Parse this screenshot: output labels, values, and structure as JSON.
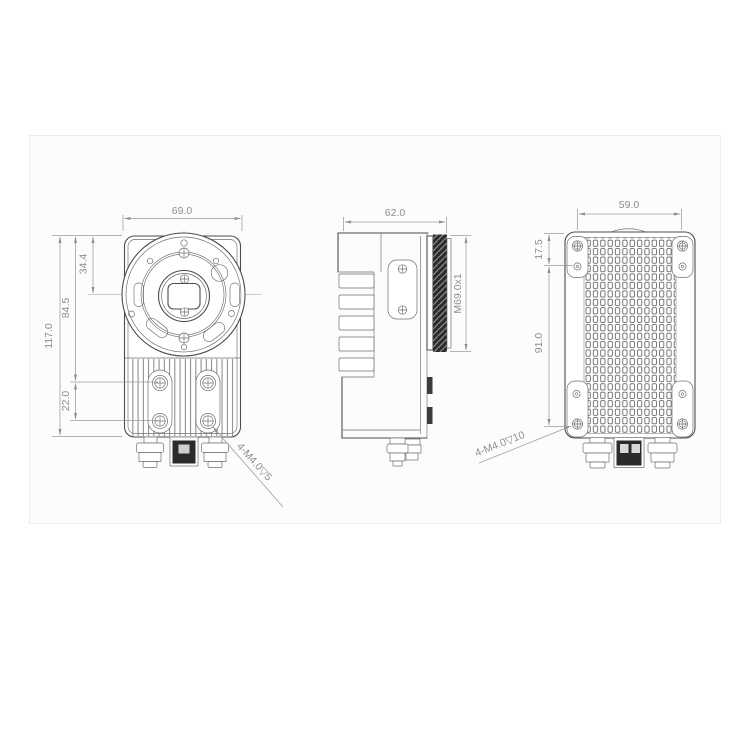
{
  "panel": {
    "background": "#fcfcfc",
    "border": "#ececec"
  },
  "colors": {
    "edge_line": "#4d4d4d",
    "thin_line": "#6e6e6e",
    "dimension_line": "#9b9b9b",
    "dimension_text": "#8d8d8d",
    "dark_fill": "#2b2b2b"
  },
  "views": {
    "front": {
      "width": "69.0",
      "overall_height": "117.0",
      "upper_section_height": "84.5",
      "lens_center_offset": "34.4",
      "mount_hole_spacing": "22.0",
      "mount_note": "4-M4.0▽5"
    },
    "side": {
      "depth": "62.0",
      "lens_thread": "M69.0x1"
    },
    "back": {
      "width": "59.0",
      "tab_hole_offset": "17.5",
      "mount_hole_spacing": "91.0",
      "mount_note": "4-M4.0▽10"
    }
  }
}
